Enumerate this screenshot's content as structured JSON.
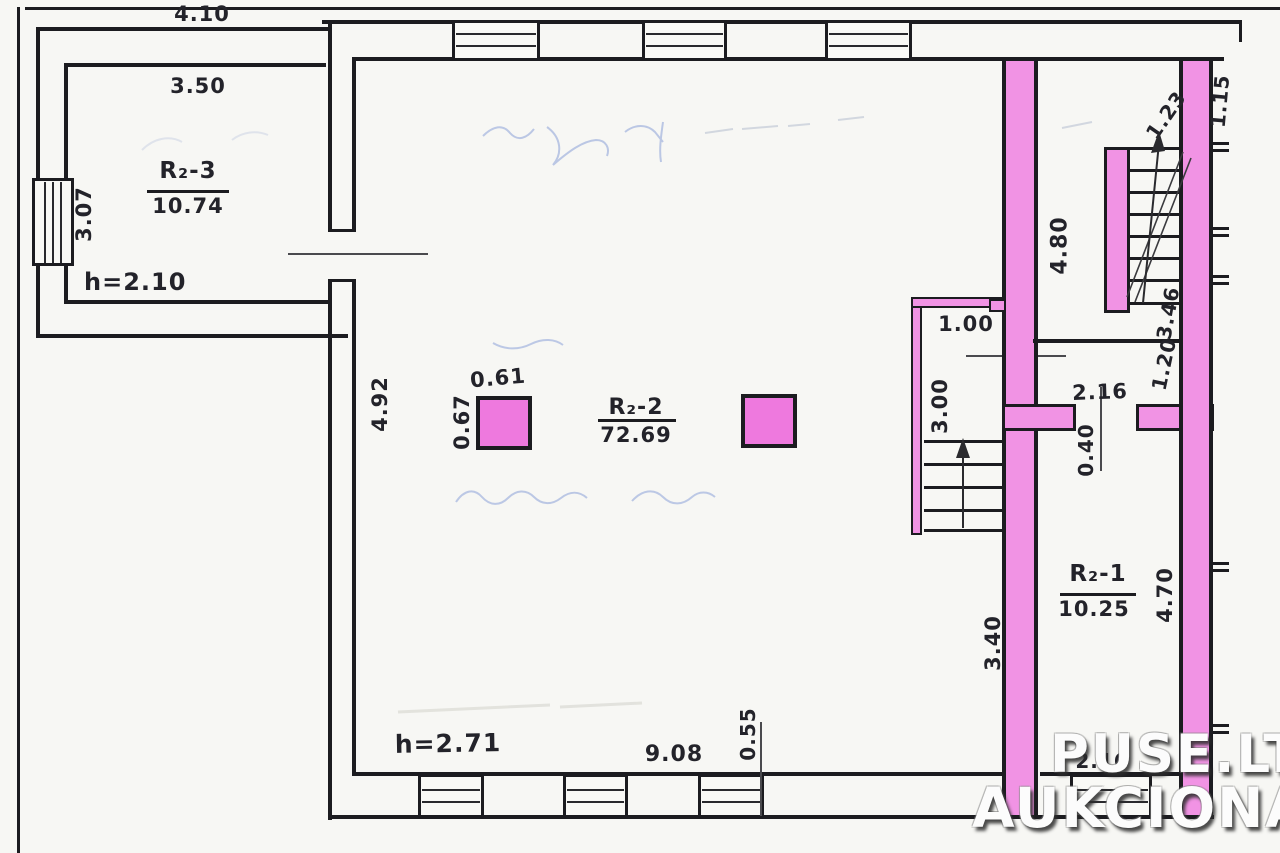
{
  "watermark": {
    "line1": "PUSE.LT",
    "line2": "AUKCIONAI"
  },
  "rooms": {
    "r3": {
      "name": "R₂-3",
      "area": "10.74",
      "ceiling_height": "h=2.10"
    },
    "r2": {
      "name": "R₂-2",
      "area": "72.69",
      "ceiling_height": "h=2.71"
    },
    "r1": {
      "name": "R₂-1",
      "area": "10.25"
    }
  },
  "dimensions": {
    "annex_top_width": "4.10",
    "annex_inner_width": "3.50",
    "annex_left_depth": "3.07",
    "main_left_depth": "4.92",
    "column_width": "0.61",
    "column_depth": "0.67",
    "alcove_width": "1.00",
    "alcove_depth": "3.00",
    "stair_hall_depth": "4.80",
    "stair_flight_rise": "1.23",
    "stair_flight_length": "3.46",
    "landing_width": "1.20",
    "right_wall_top": "1.15",
    "small_room_width": "2.16",
    "door_width": "0.40",
    "r1_depth": "4.70",
    "corridor_depth": "3.40",
    "main_bottom_width": "9.08",
    "bottom_wall_offset": "0.55",
    "r1_bottom_width": "2.16"
  },
  "colors": {
    "wall_highlight": "#f193e4",
    "column_fill": "#ee79de",
    "ink": "#1c1c20",
    "pencil_blue": "#94a8da",
    "paper": "#f7f7f4"
  }
}
